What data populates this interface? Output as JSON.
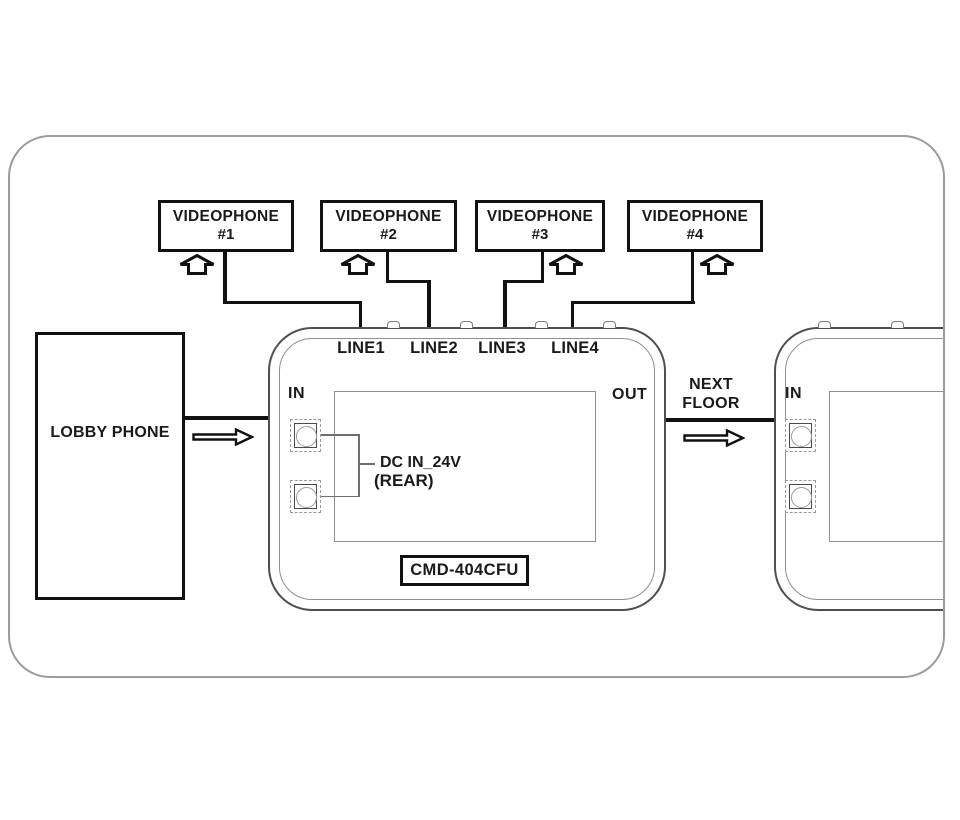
{
  "diagram": {
    "videophones": [
      {
        "name": "VIDEOPHONE",
        "number": "#1"
      },
      {
        "name": "VIDEOPHONE",
        "number": "#2"
      },
      {
        "name": "VIDEOPHONE",
        "number": "#3"
      },
      {
        "name": "VIDEOPHONE",
        "number": "#4"
      }
    ],
    "central_unit": {
      "lines": [
        "LINE1",
        "LINE2",
        "LINE3",
        "LINE4"
      ],
      "in_label": "IN",
      "out_label": "OUT",
      "dc_label": "DC IN_24V",
      "rear_label": "(REAR)",
      "model_label": "CMD-404CFU"
    },
    "lobby_phone": {
      "label": "LOBBY PHONE"
    },
    "next_floor": {
      "label": "NEXT\nFLOOR"
    },
    "right_unit": {
      "in_label": "IN"
    },
    "icons": {
      "up_arrow": "hollow-up-arrow",
      "flow_arrow": "hollow-right-arrow"
    },
    "colors": {
      "wire": "#111111",
      "frame_border": "#9b9b9b",
      "unit_border": "#4f4f4f",
      "panel_border": "#8f8f8f",
      "background": "#ffffff"
    }
  }
}
